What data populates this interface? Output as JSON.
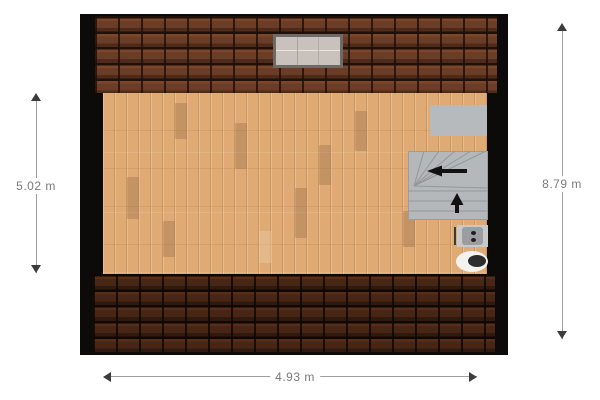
{
  "floorplan": {
    "type": "attic-floor-plan",
    "dimensions": {
      "left": {
        "label": "5.02 m"
      },
      "right": {
        "label": "8.79 m"
      },
      "bottom": {
        "label": "4.93 m"
      }
    },
    "objects": {
      "skylight": "roof-window",
      "closet": "built-in-cabinet",
      "stairs": "winder-staircase",
      "stairs_arrows": [
        "left-direction-arrow",
        "up-direction-arrow"
      ],
      "sink": "washbasin",
      "toilet": "toilet"
    },
    "colors": {
      "background": "#ffffff",
      "wall": "#0c0b0a",
      "roof_top": "#6b3d27",
      "roof_bottom": "#482615",
      "floor": "#dfaa74",
      "skylight_pane": "#c9c1bc",
      "skylight_frame": "#6e6a67",
      "cabinet": "#b7babd",
      "stairs": "#b5b8bb",
      "stair_line": "#94979a",
      "fixture": "#9b9ea1",
      "toilet": "#f3f2f0",
      "toilet_seat": "#2d2d2d",
      "arrow_black": "#121212",
      "dim_line": "#9e9e9e",
      "dim_arrow": "#3c3c3c",
      "dim_text": "#7a7a7a"
    }
  }
}
